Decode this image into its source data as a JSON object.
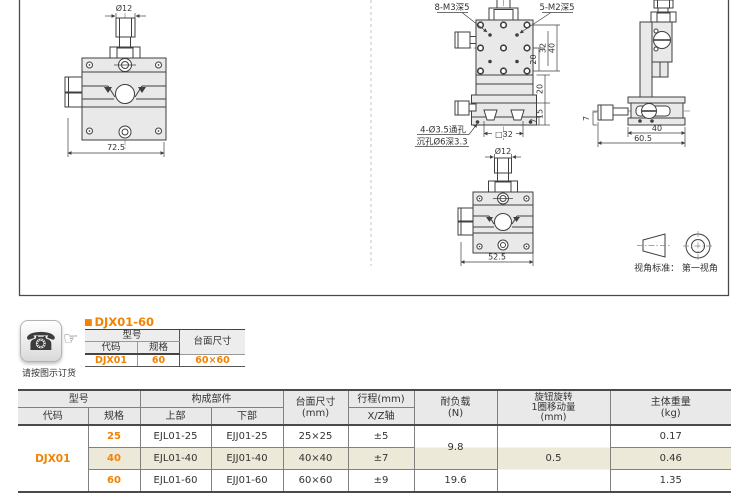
{
  "accent_orange": "#f08300",
  "icons": {
    "phone": "☎",
    "pointer": "☞"
  },
  "drawings": {
    "front_view": {
      "dia_label": "Ø12",
      "width_dim": "72.5"
    },
    "top_view": {
      "thread_note_left": "8-M3深5",
      "thread_note_right": "5-M2深5",
      "dim_20_upper": "20",
      "dim_32": "32",
      "dim_40": "40",
      "dim_20_lower": "20",
      "dim_15": "15",
      "dim_7": "7",
      "dim_square": "□32",
      "hole_note_line1": "4-Ø3.5通孔",
      "hole_note_line2": "沉孔Ø6深3.3"
    },
    "side_view": {
      "dim_7": "7",
      "dim_40": "40",
      "dim_60_5": "60.5"
    },
    "bottom_view": {
      "dia_label": "Ø12",
      "width_dim": "52.5"
    },
    "projection_note": "视角标准： 第一视角"
  },
  "order": {
    "caption": "请按图示订货",
    "bullet": "■",
    "title": "DJX01-60",
    "table": {
      "model": "型号",
      "code_h": "代码",
      "spec_h": "规格",
      "size_h": "台面尺寸",
      "code": "DJX01",
      "spec": "60",
      "size": "60×60"
    }
  },
  "spec_table": {
    "group_model": "型号",
    "group_parts": "构成部件",
    "col_code": "代码",
    "col_spec": "规格",
    "col_upper": "上部",
    "col_lower": "下部",
    "col_size_1": "台面尺寸",
    "col_size_2": "(mm)",
    "col_travel": "行程(mm)",
    "col_travel_sub": "X/Z轴",
    "col_load_1": "耐负载",
    "col_load_2": "(N)",
    "col_knob_1": "旋钮旋转",
    "col_knob_2": "1圈移动量",
    "col_knob_3": "(mm)",
    "col_weight_1": "主体重量",
    "col_weight_2": "(kg)",
    "code": "DJX01",
    "rows": [
      {
        "spec": "25",
        "upper": "EJL01-25",
        "lower": "EJJ01-25",
        "size": "25×25",
        "travel": "±5",
        "weight": "0.17"
      },
      {
        "spec": "40",
        "upper": "EJL01-40",
        "lower": "EJJ01-40",
        "size": "40×40",
        "travel": "±7",
        "weight": "0.46"
      },
      {
        "spec": "60",
        "upper": "EJL01-60",
        "lower": "EJJ01-60",
        "size": "60×60",
        "travel": "±9",
        "weight": "1.35"
      }
    ],
    "load_25_40": "9.8",
    "load_60": "19.6",
    "knob_travel": "0.5"
  }
}
